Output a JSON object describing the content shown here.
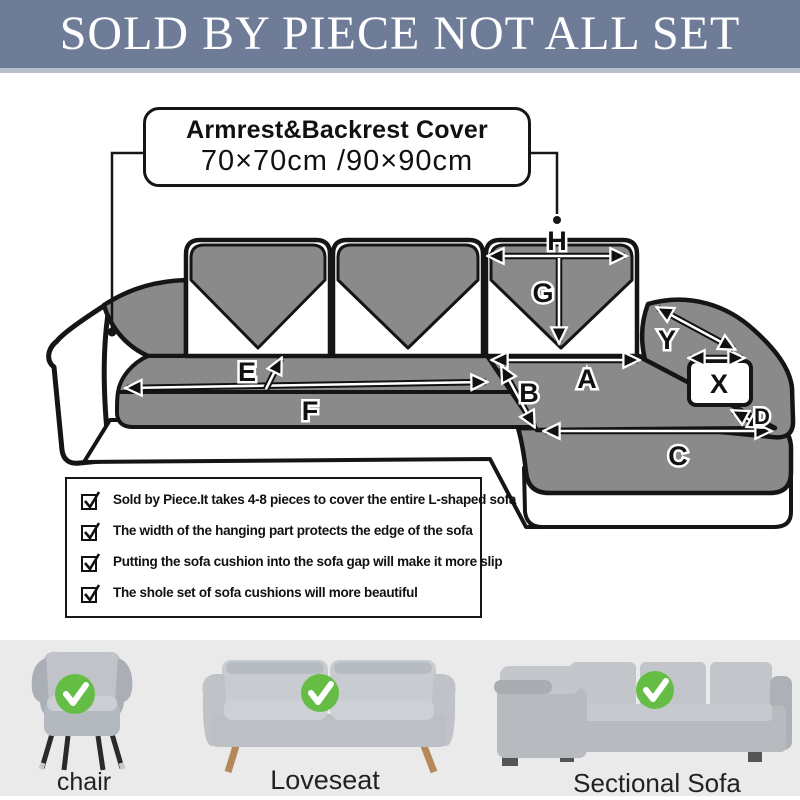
{
  "banner": {
    "title": "SOLD BY PIECE NOT ALL SET"
  },
  "callout": {
    "title": "Armrest&Backrest Cover",
    "sizes": "70×70cm /90×90cm"
  },
  "diagram": {
    "labels": {
      "a": "A",
      "b": "B",
      "c": "C",
      "d": "D",
      "e": "E",
      "f": "F",
      "g": "G",
      "h": "H",
      "x": "X",
      "y": "Y"
    }
  },
  "checklist": {
    "items": [
      "Sold by Piece.It takes 4-8 pieces to cover the entire L-shaped sofa",
      "The width of the hanging part protects the edge of the sofa",
      "Putting the sofa cushion into the sofa gap will make it more slip",
      "The shole set of sofa cushions will more beautiful"
    ]
  },
  "products": [
    {
      "label": "chair"
    },
    {
      "label": "Loveseat"
    },
    {
      "label": "Sectional Sofa"
    }
  ],
  "colors": {
    "banner_bg": "#6e7c98",
    "sofa_gray": "#8a8a8a",
    "outline": "#151515",
    "badge_green": "#66bd45",
    "bottom_bg": "#eaeaea"
  }
}
